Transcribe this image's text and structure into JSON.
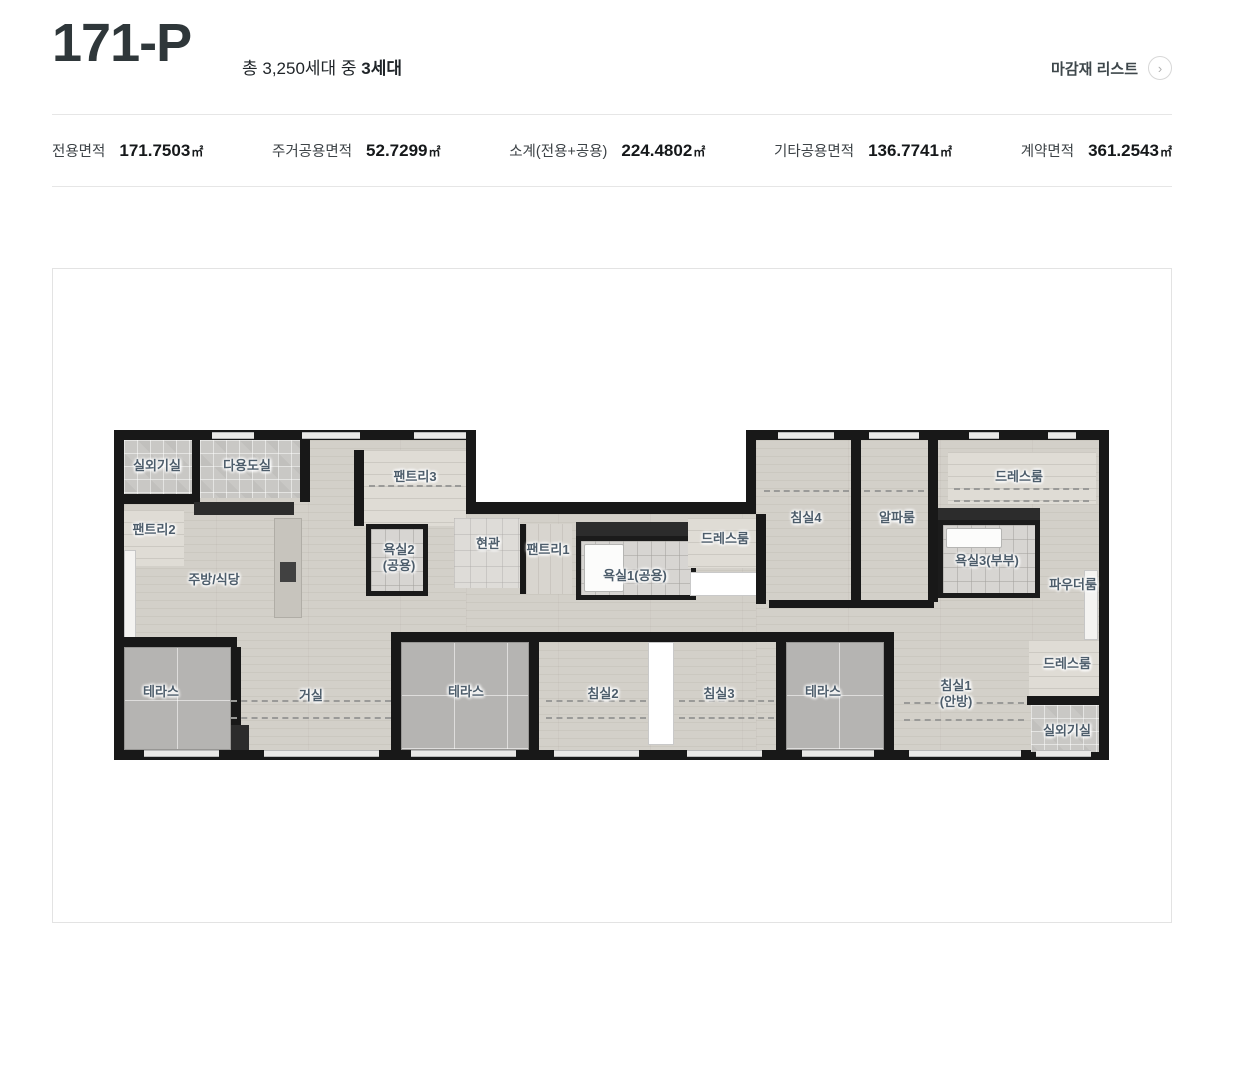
{
  "header": {
    "title": "171-P",
    "subtitle_prefix": "총 3,250세대 중 ",
    "subtitle_bold": "3세대",
    "finish_link": "마감재 리스트",
    "finish_link_icon": "chevron-right-circle"
  },
  "specs": [
    {
      "label": "전용면적",
      "value": "171.7503",
      "unit": "㎡"
    },
    {
      "label": "주거공용면적",
      "value": "52.7299",
      "unit": "㎡"
    },
    {
      "label": "소계(전용+공용)",
      "value": "224.4802",
      "unit": "㎡"
    },
    {
      "label": "기타공용면적",
      "value": "136.7741",
      "unit": "㎡"
    },
    {
      "label": "계약면적",
      "value": "361.2543",
      "unit": "㎡"
    }
  ],
  "colors": {
    "wall": "#181818",
    "floor": "#d3d0c9",
    "terrace": "#b5b4b2",
    "room_label": "#4d5d6b",
    "divider": "#e6e6e6",
    "title_text": "#2f373a"
  },
  "floorplan": {
    "rects": [
      {
        "t": "base",
        "n": "unit-footprint",
        "x": 0,
        "y": 0,
        "w": 995,
        "h": 330
      },
      {
        "t": "notch",
        "n": "top-notch",
        "x": 362,
        "y": 0,
        "w": 270,
        "h": 72
      },
      {
        "t": "floor",
        "n": "floor-left",
        "x": 10,
        "y": 10,
        "w": 342,
        "h": 310
      },
      {
        "t": "floor",
        "n": "floor-mid",
        "x": 352,
        "y": 84,
        "w": 290,
        "h": 236
      },
      {
        "t": "floor",
        "n": "floor-right",
        "x": 642,
        "y": 10,
        "w": 343,
        "h": 310
      },
      {
        "t": "checker",
        "n": "room-outdoor-unit-1",
        "x": 10,
        "y": 10,
        "w": 68,
        "h": 54
      },
      {
        "t": "wall",
        "x": 10,
        "y": 64,
        "w": 68,
        "h": 10
      },
      {
        "t": "wall",
        "x": 78,
        "y": 10,
        "w": 8,
        "h": 64
      },
      {
        "t": "checker",
        "n": "room-utility",
        "x": 86,
        "y": 10,
        "w": 100,
        "h": 58
      },
      {
        "t": "wall",
        "x": 186,
        "y": 10,
        "w": 10,
        "h": 62
      },
      {
        "t": "dark",
        "n": "kitchen-counter",
        "x": 80,
        "y": 72,
        "w": 100,
        "h": 13
      },
      {
        "t": "closet",
        "n": "room-pantry2",
        "x": 10,
        "y": 80,
        "w": 60,
        "h": 56
      },
      {
        "t": "winstrip",
        "n": "window-left",
        "x": 10,
        "y": 120,
        "w": 12,
        "h": 90
      },
      {
        "t": "island",
        "n": "kitchen-island",
        "x": 160,
        "y": 88,
        "w": 28,
        "h": 100
      },
      {
        "t": "stove",
        "n": "cooktop",
        "x": 166,
        "y": 132,
        "w": 16,
        "h": 20
      },
      {
        "t": "wall",
        "x": 240,
        "y": 20,
        "w": 10,
        "h": 76
      },
      {
        "t": "closet",
        "n": "room-pantry3",
        "x": 250,
        "y": 20,
        "w": 102,
        "h": 76
      },
      {
        "t": "bath",
        "n": "room-bath2",
        "x": 252,
        "y": 94,
        "w": 62,
        "h": 72
      },
      {
        "t": "tile",
        "n": "room-entrance",
        "x": 340,
        "y": 88,
        "w": 66,
        "h": 70
      },
      {
        "t": "wall",
        "x": 406,
        "y": 94,
        "w": 6,
        "h": 70
      },
      {
        "t": "closet2",
        "n": "room-pantry1",
        "x": 412,
        "y": 94,
        "w": 46,
        "h": 70
      },
      {
        "t": "dark",
        "x": 462,
        "y": 92,
        "w": 120,
        "h": 14
      },
      {
        "t": "bath",
        "n": "room-bath1",
        "x": 462,
        "y": 106,
        "w": 120,
        "h": 64
      },
      {
        "t": "tub",
        "n": "bathtub-1",
        "x": 470,
        "y": 114,
        "w": 40,
        "h": 48
      },
      {
        "t": "closet",
        "n": "room-dress-mid",
        "x": 574,
        "y": 88,
        "w": 74,
        "h": 50
      },
      {
        "t": "white",
        "x": 576,
        "y": 142,
        "w": 68,
        "h": 24
      },
      {
        "t": "wall",
        "x": 642,
        "y": 84,
        "w": 10,
        "h": 90
      },
      {
        "t": "wall",
        "x": 737,
        "y": 10,
        "w": 10,
        "h": 162
      },
      {
        "t": "wall",
        "x": 814,
        "y": 10,
        "w": 10,
        "h": 162
      },
      {
        "t": "closet",
        "n": "room-dress-tr",
        "x": 834,
        "y": 22,
        "w": 148,
        "h": 52
      },
      {
        "t": "dark",
        "x": 824,
        "y": 78,
        "w": 102,
        "h": 12
      },
      {
        "t": "bath",
        "n": "room-bath3",
        "x": 824,
        "y": 90,
        "w": 102,
        "h": 78
      },
      {
        "t": "tub",
        "n": "bathtub-3",
        "x": 832,
        "y": 98,
        "w": 56,
        "h": 20
      },
      {
        "t": "winstrip",
        "n": "window-powder",
        "x": 970,
        "y": 140,
        "w": 14,
        "h": 70
      },
      {
        "t": "wall",
        "x": 655,
        "y": 170,
        "w": 165,
        "h": 8
      },
      {
        "t": "wall",
        "x": 5,
        "y": 207,
        "w": 118,
        "h": 10
      },
      {
        "t": "terrace",
        "n": "room-terrace-left",
        "x": 10,
        "y": 217,
        "w": 107,
        "h": 103
      },
      {
        "t": "wall",
        "x": 117,
        "y": 217,
        "w": 10,
        "h": 85
      },
      {
        "t": "dark",
        "x": 117,
        "y": 295,
        "w": 18,
        "h": 25
      },
      {
        "t": "wall",
        "x": 277,
        "y": 202,
        "w": 148,
        "h": 10
      },
      {
        "t": "wall",
        "x": 277,
        "y": 202,
        "w": 10,
        "h": 128
      },
      {
        "t": "wall",
        "x": 415,
        "y": 202,
        "w": 10,
        "h": 128
      },
      {
        "t": "terrace",
        "n": "room-terrace-mid",
        "x": 287,
        "y": 212,
        "w": 128,
        "h": 108
      },
      {
        "t": "wall",
        "x": 425,
        "y": 202,
        "w": 112,
        "h": 10
      },
      {
        "t": "white",
        "n": "closet-bed2-bed3",
        "x": 534,
        "y": 212,
        "w": 26,
        "h": 103
      },
      {
        "t": "wall",
        "x": 534,
        "y": 202,
        "w": 26,
        "h": 10
      },
      {
        "t": "wall",
        "x": 560,
        "y": 202,
        "w": 102,
        "h": 10
      },
      {
        "t": "wall",
        "x": 662,
        "y": 202,
        "w": 118,
        "h": 10
      },
      {
        "t": "wall",
        "x": 662,
        "y": 202,
        "w": 10,
        "h": 128
      },
      {
        "t": "terrace",
        "n": "room-terrace-right",
        "x": 672,
        "y": 212,
        "w": 98,
        "h": 108
      },
      {
        "t": "wall",
        "x": 770,
        "y": 202,
        "w": 10,
        "h": 128
      },
      {
        "t": "closet",
        "n": "room-dress-br",
        "x": 915,
        "y": 210,
        "w": 70,
        "h": 56
      },
      {
        "t": "wall",
        "x": 913,
        "y": 266,
        "w": 77,
        "h": 9
      },
      {
        "t": "checker",
        "n": "room-outdoor-unit-2",
        "x": 917,
        "y": 275,
        "w": 68,
        "h": 47
      },
      {
        "t": "window",
        "x": 98,
        "y": 2,
        "w": 42,
        "h": 7
      },
      {
        "t": "window",
        "x": 188,
        "y": 2,
        "w": 58,
        "h": 7
      },
      {
        "t": "window",
        "x": 300,
        "y": 2,
        "w": 52,
        "h": 7
      },
      {
        "t": "window",
        "x": 664,
        "y": 2,
        "w": 56,
        "h": 7
      },
      {
        "t": "window",
        "x": 755,
        "y": 2,
        "w": 50,
        "h": 7
      },
      {
        "t": "window",
        "x": 855,
        "y": 2,
        "w": 30,
        "h": 7
      },
      {
        "t": "window",
        "x": 934,
        "y": 2,
        "w": 28,
        "h": 7
      },
      {
        "t": "window",
        "x": 30,
        "y": 320,
        "w": 75,
        "h": 7
      },
      {
        "t": "window",
        "x": 150,
        "y": 320,
        "w": 115,
        "h": 7
      },
      {
        "t": "window",
        "x": 297,
        "y": 320,
        "w": 105,
        "h": 7
      },
      {
        "t": "window",
        "x": 440,
        "y": 320,
        "w": 85,
        "h": 7
      },
      {
        "t": "window",
        "x": 573,
        "y": 320,
        "w": 75,
        "h": 7
      },
      {
        "t": "window",
        "x": 688,
        "y": 320,
        "w": 72,
        "h": 7
      },
      {
        "t": "window",
        "x": 795,
        "y": 320,
        "w": 112,
        "h": 7
      },
      {
        "t": "window",
        "x": 922,
        "y": 320,
        "w": 55,
        "h": 7
      },
      {
        "t": "dash",
        "x": 117,
        "y": 270,
        "w": 160,
        "h": 0
      },
      {
        "t": "dash",
        "x": 117,
        "y": 287,
        "w": 160,
        "h": 0
      },
      {
        "t": "dash",
        "x": 432,
        "y": 270,
        "w": 100,
        "h": 0
      },
      {
        "t": "dash",
        "x": 432,
        "y": 287,
        "w": 100,
        "h": 0
      },
      {
        "t": "dash",
        "x": 565,
        "y": 270,
        "w": 95,
        "h": 0
      },
      {
        "t": "dash",
        "x": 565,
        "y": 287,
        "w": 95,
        "h": 0
      },
      {
        "t": "dash",
        "x": 790,
        "y": 272,
        "w": 120,
        "h": 0
      },
      {
        "t": "dash",
        "x": 790,
        "y": 289,
        "w": 120,
        "h": 0
      },
      {
        "t": "dash",
        "x": 650,
        "y": 60,
        "w": 85,
        "h": 0
      },
      {
        "t": "dash",
        "x": 750,
        "y": 60,
        "w": 60,
        "h": 0
      },
      {
        "t": "dash",
        "x": 840,
        "y": 58,
        "w": 135,
        "h": 0
      },
      {
        "t": "dash",
        "x": 840,
        "y": 70,
        "w": 135,
        "h": 0
      },
      {
        "t": "dash",
        "x": 255,
        "y": 55,
        "w": 92,
        "h": 0
      }
    ],
    "labels": [
      {
        "text": "실외기실",
        "x": 43,
        "y": 36
      },
      {
        "text": "다용도실",
        "x": 133,
        "y": 36
      },
      {
        "text": "팬트리2",
        "x": 40,
        "y": 100
      },
      {
        "text": "팬트리3",
        "x": 301,
        "y": 47
      },
      {
        "text": "주방/식당",
        "x": 100,
        "y": 150
      },
      {
        "text": "욕실2\n(공용)",
        "x": 285,
        "y": 128
      },
      {
        "text": "현관",
        "x": 374,
        "y": 114
      },
      {
        "text": "팬트리1",
        "x": 434,
        "y": 120
      },
      {
        "text": "욕실1(공용)",
        "x": 521,
        "y": 146
      },
      {
        "text": "드레스룸",
        "x": 611,
        "y": 109
      },
      {
        "text": "침실4",
        "x": 692,
        "y": 88
      },
      {
        "text": "알파룸",
        "x": 783,
        "y": 88
      },
      {
        "text": "드레스룸",
        "x": 905,
        "y": 47
      },
      {
        "text": "욕실3(부부)",
        "x": 873,
        "y": 131
      },
      {
        "text": "파우더룸",
        "x": 959,
        "y": 155
      },
      {
        "text": "테라스",
        "x": 47,
        "y": 262
      },
      {
        "text": "거실",
        "x": 197,
        "y": 266
      },
      {
        "text": "테라스",
        "x": 352,
        "y": 262
      },
      {
        "text": "침실2",
        "x": 489,
        "y": 264
      },
      {
        "text": "침실3",
        "x": 605,
        "y": 264
      },
      {
        "text": "테라스",
        "x": 709,
        "y": 262
      },
      {
        "text": "침실1\n(안방)",
        "x": 842,
        "y": 264
      },
      {
        "text": "드레스룸",
        "x": 953,
        "y": 234
      },
      {
        "text": "실외기실",
        "x": 953,
        "y": 301
      }
    ]
  }
}
